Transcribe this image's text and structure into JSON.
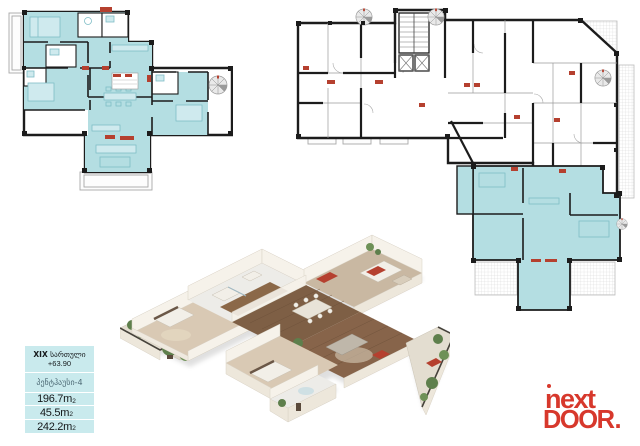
{
  "info_panel": {
    "floor_roman": "XIX",
    "floor_word": "სართული",
    "elevation": "+63.90",
    "unit_label": "პენტჰაუსი-4",
    "areas": [
      {
        "value": "196.7",
        "unit": "m",
        "sup": "2"
      },
      {
        "value": "45.5",
        "unit": "m",
        "sup": "2"
      },
      {
        "value": "242.2",
        "unit": "m",
        "sup": "2"
      }
    ]
  },
  "logo": {
    "word1": "next",
    "word2": "DOOR",
    "dot": "."
  },
  "colors": {
    "teal_fill": "#B4DEE2",
    "box_bg": "#C9EAED",
    "wall": "#1C1C1C",
    "marker_red": "#B5402F",
    "logo_red": "#D7382C"
  }
}
